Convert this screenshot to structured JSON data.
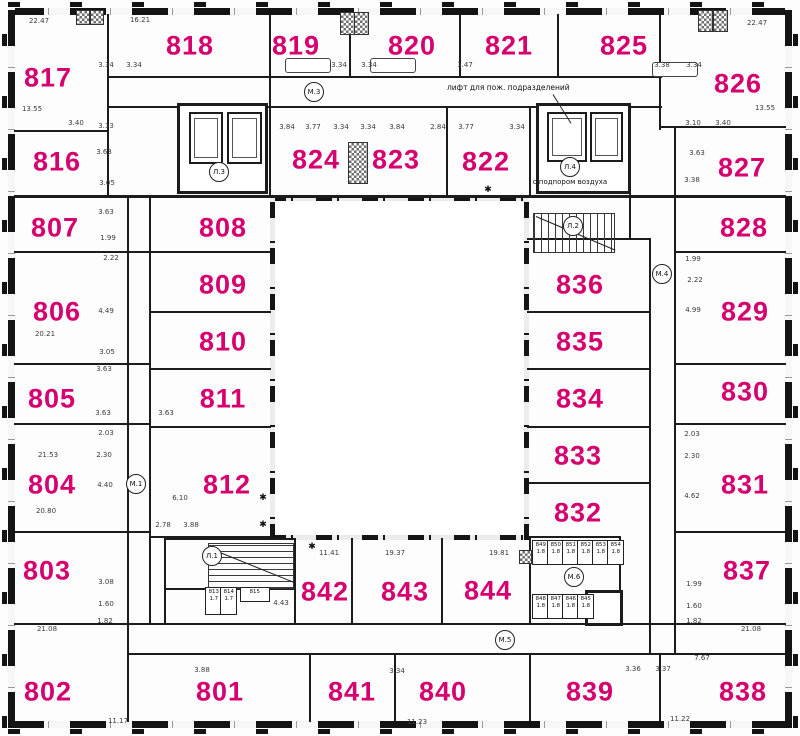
{
  "colors": {
    "room_label": "#d6006e",
    "wall": "#1c1c1c",
    "dim_text": "#3a3a3a"
  },
  "annotations": {
    "elevator_note": "лифт для пож. подразделений",
    "air_note": "с подпором воздуха",
    "asterisk_symbol": "✱"
  },
  "rooms": [
    {
      "label": "817",
      "x": 48,
      "y": 78
    },
    {
      "label": "818",
      "x": 190,
      "y": 46
    },
    {
      "label": "819",
      "x": 296,
      "y": 46
    },
    {
      "label": "820",
      "x": 412,
      "y": 46
    },
    {
      "label": "821",
      "x": 509,
      "y": 46
    },
    {
      "label": "825",
      "x": 624,
      "y": 46
    },
    {
      "label": "826",
      "x": 738,
      "y": 84
    },
    {
      "label": "816",
      "x": 57,
      "y": 162
    },
    {
      "label": "824",
      "x": 316,
      "y": 160
    },
    {
      "label": "823",
      "x": 396,
      "y": 160
    },
    {
      "label": "822",
      "x": 486,
      "y": 162
    },
    {
      "label": "827",
      "x": 742,
      "y": 168
    },
    {
      "label": "807",
      "x": 55,
      "y": 228
    },
    {
      "label": "808",
      "x": 223,
      "y": 228
    },
    {
      "label": "828",
      "x": 744,
      "y": 228
    },
    {
      "label": "806",
      "x": 57,
      "y": 312
    },
    {
      "label": "809",
      "x": 223,
      "y": 285
    },
    {
      "label": "829",
      "x": 745,
      "y": 312
    },
    {
      "label": "810",
      "x": 223,
      "y": 342
    },
    {
      "label": "836",
      "x": 580,
      "y": 285
    },
    {
      "label": "835",
      "x": 580,
      "y": 342
    },
    {
      "label": "805",
      "x": 52,
      "y": 399
    },
    {
      "label": "811",
      "x": 223,
      "y": 399
    },
    {
      "label": "830",
      "x": 745,
      "y": 392
    },
    {
      "label": "834",
      "x": 580,
      "y": 399
    },
    {
      "label": "804",
      "x": 52,
      "y": 485
    },
    {
      "label": "812",
      "x": 227,
      "y": 485
    },
    {
      "label": "833",
      "x": 578,
      "y": 456
    },
    {
      "label": "831",
      "x": 745,
      "y": 485
    },
    {
      "label": "832",
      "x": 578,
      "y": 513
    },
    {
      "label": "803",
      "x": 47,
      "y": 571
    },
    {
      "label": "842",
      "x": 325,
      "y": 592
    },
    {
      "label": "843",
      "x": 405,
      "y": 592
    },
    {
      "label": "844",
      "x": 488,
      "y": 591
    },
    {
      "label": "837",
      "x": 747,
      "y": 571
    },
    {
      "label": "802",
      "x": 48,
      "y": 692
    },
    {
      "label": "801",
      "x": 220,
      "y": 692
    },
    {
      "label": "841",
      "x": 352,
      "y": 692
    },
    {
      "label": "840",
      "x": 443,
      "y": 692
    },
    {
      "label": "839",
      "x": 590,
      "y": 692
    },
    {
      "label": "838",
      "x": 743,
      "y": 692
    }
  ],
  "cores": [
    {
      "label": "М.3",
      "x": 314,
      "y": 92
    },
    {
      "label": "Л.3",
      "x": 219,
      "y": 172
    },
    {
      "label": "Л.4",
      "x": 570,
      "y": 167,
      "note": "с подпором воздуха",
      "note_y": 182
    },
    {
      "label": "Л.2",
      "x": 573,
      "y": 226
    },
    {
      "label": "М.4",
      "x": 662,
      "y": 274
    },
    {
      "label": "М.1",
      "x": 136,
      "y": 484
    },
    {
      "label": "Л.1",
      "x": 212,
      "y": 556
    },
    {
      "label": "М.6",
      "x": 574,
      "y": 577
    },
    {
      "label": "М.5",
      "x": 505,
      "y": 640
    }
  ],
  "storage_cells": [
    {
      "label": "813",
      "area": "1.7",
      "x": 205,
      "y": 587,
      "w": 15,
      "h": 26
    },
    {
      "label": "814",
      "area": "1.7",
      "x": 220,
      "y": 587,
      "w": 15,
      "h": 26
    },
    {
      "label": "815",
      "area": "",
      "x": 240,
      "y": 587,
      "w": 28,
      "h": 13
    },
    {
      "label": "849",
      "area": "1.8",
      "x": 532,
      "y": 540,
      "w": 15,
      "h": 23
    },
    {
      "label": "850",
      "area": "1.8",
      "x": 547,
      "y": 540,
      "w": 15,
      "h": 23
    },
    {
      "label": "851",
      "area": "1.8",
      "x": 562,
      "y": 540,
      "w": 15,
      "h": 23
    },
    {
      "label": "852",
      "area": "1.8",
      "x": 577,
      "y": 540,
      "w": 15,
      "h": 23
    },
    {
      "label": "853",
      "area": "1.8",
      "x": 592,
      "y": 540,
      "w": 15,
      "h": 23
    },
    {
      "label": "854",
      "area": "1.8",
      "x": 607,
      "y": 540,
      "w": 15,
      "h": 23
    },
    {
      "label": "848",
      "area": "1.8",
      "x": 532,
      "y": 594,
      "w": 15,
      "h": 23
    },
    {
      "label": "847",
      "area": "1.8",
      "x": 547,
      "y": 594,
      "w": 15,
      "h": 23
    },
    {
      "label": "846",
      "area": "1.8",
      "x": 562,
      "y": 594,
      "w": 15,
      "h": 23
    },
    {
      "label": "845",
      "area": "1.8",
      "x": 577,
      "y": 594,
      "w": 15,
      "h": 23
    }
  ],
  "dimensions": [
    {
      "text": "22.47",
      "x": 39,
      "y": 21
    },
    {
      "text": "16.21",
      "x": 140,
      "y": 20
    },
    {
      "text": "22.47",
      "x": 757,
      "y": 23
    },
    {
      "text": "3.34",
      "x": 106,
      "y": 65
    },
    {
      "text": "3.34",
      "x": 134,
      "y": 65
    },
    {
      "text": "3.34",
      "x": 339,
      "y": 65
    },
    {
      "text": "3.34",
      "x": 369,
      "y": 65
    },
    {
      "text": "3.47",
      "x": 465,
      "y": 65
    },
    {
      "text": "3.38",
      "x": 662,
      "y": 65
    },
    {
      "text": "3.34",
      "x": 694,
      "y": 65
    },
    {
      "text": "13.55",
      "x": 32,
      "y": 109
    },
    {
      "text": "3.40",
      "x": 76,
      "y": 123
    },
    {
      "text": "3.13",
      "x": 106,
      "y": 126
    },
    {
      "text": "3.10",
      "x": 693,
      "y": 123
    },
    {
      "text": "3.40",
      "x": 723,
      "y": 123
    },
    {
      "text": "13.55",
      "x": 765,
      "y": 108
    },
    {
      "text": "3.84",
      "x": 287,
      "y": 127
    },
    {
      "text": "3.77",
      "x": 313,
      "y": 127
    },
    {
      "text": "3.34",
      "x": 341,
      "y": 127
    },
    {
      "text": "3.34",
      "x": 368,
      "y": 127
    },
    {
      "text": "3.84",
      "x": 397,
      "y": 127
    },
    {
      "text": "2.84",
      "x": 438,
      "y": 127
    },
    {
      "text": "3.77",
      "x": 466,
      "y": 127
    },
    {
      "text": "3.34",
      "x": 517,
      "y": 127
    },
    {
      "text": "3.63",
      "x": 104,
      "y": 152
    },
    {
      "text": "3.63",
      "x": 697,
      "y": 153
    },
    {
      "text": "3.38",
      "x": 692,
      "y": 180
    },
    {
      "text": "3.05",
      "x": 107,
      "y": 183
    },
    {
      "text": "3.63",
      "x": 106,
      "y": 212
    },
    {
      "text": "1.99",
      "x": 108,
      "y": 238
    },
    {
      "text": "2.22",
      "x": 111,
      "y": 258
    },
    {
      "text": "1.99",
      "x": 693,
      "y": 259
    },
    {
      "text": "2.22",
      "x": 695,
      "y": 280
    },
    {
      "text": "4.99",
      "x": 693,
      "y": 310
    },
    {
      "text": "20.21",
      "x": 45,
      "y": 334
    },
    {
      "text": "4.49",
      "x": 106,
      "y": 311
    },
    {
      "text": "3.05",
      "x": 107,
      "y": 352
    },
    {
      "text": "3.63",
      "x": 104,
      "y": 369
    },
    {
      "text": "3.63",
      "x": 103,
      "y": 413
    },
    {
      "text": "3.63",
      "x": 166,
      "y": 413
    },
    {
      "text": "2.03",
      "x": 106,
      "y": 433
    },
    {
      "text": "21.53",
      "x": 48,
      "y": 455
    },
    {
      "text": "2.30",
      "x": 104,
      "y": 455
    },
    {
      "text": "4.40",
      "x": 105,
      "y": 485
    },
    {
      "text": "20.80",
      "x": 46,
      "y": 511
    },
    {
      "text": "2.03",
      "x": 692,
      "y": 434
    },
    {
      "text": "2.30",
      "x": 692,
      "y": 456
    },
    {
      "text": "4.62",
      "x": 692,
      "y": 496
    },
    {
      "text": "6.10",
      "x": 180,
      "y": 498
    },
    {
      "text": "2.78",
      "x": 163,
      "y": 525
    },
    {
      "text": "3.88",
      "x": 191,
      "y": 525
    },
    {
      "text": "3.08",
      "x": 106,
      "y": 582
    },
    {
      "text": "1.60",
      "x": 106,
      "y": 604
    },
    {
      "text": "1.82",
      "x": 105,
      "y": 621
    },
    {
      "text": "21.08",
      "x": 47,
      "y": 629
    },
    {
      "text": "1.99",
      "x": 694,
      "y": 584
    },
    {
      "text": "1.60",
      "x": 694,
      "y": 606
    },
    {
      "text": "1.82",
      "x": 694,
      "y": 621
    },
    {
      "text": "21.08",
      "x": 751,
      "y": 629
    },
    {
      "text": "7.67",
      "x": 702,
      "y": 658
    },
    {
      "text": "11.41",
      "x": 329,
      "y": 553
    },
    {
      "text": "19.37",
      "x": 395,
      "y": 553
    },
    {
      "text": "19.81",
      "x": 499,
      "y": 553
    },
    {
      "text": "4.43",
      "x": 281,
      "y": 603
    },
    {
      "text": "3.88",
      "x": 202,
      "y": 670
    },
    {
      "text": "3.34",
      "x": 397,
      "y": 671
    },
    {
      "text": "3.36",
      "x": 633,
      "y": 669
    },
    {
      "text": "3.37",
      "x": 663,
      "y": 669
    },
    {
      "text": "11.17",
      "x": 118,
      "y": 721
    },
    {
      "text": "11.23",
      "x": 417,
      "y": 722
    },
    {
      "text": "11.22",
      "x": 680,
      "y": 719
    }
  ],
  "asterisks": [
    {
      "x": 488,
      "y": 190
    },
    {
      "x": 263,
      "y": 498
    },
    {
      "x": 263,
      "y": 525
    },
    {
      "x": 312,
      "y": 547
    }
  ]
}
